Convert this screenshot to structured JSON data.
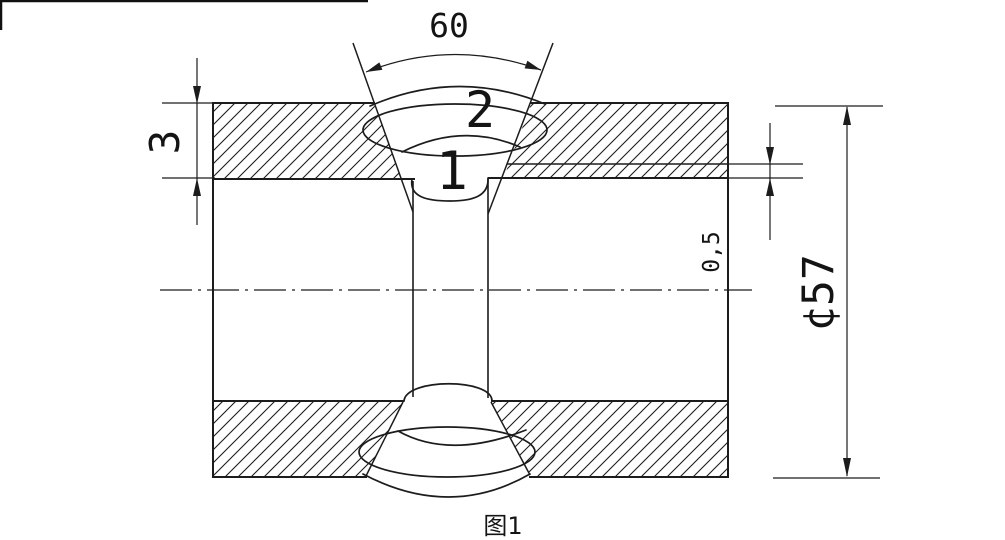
{
  "drawing": {
    "caption": "图1",
    "dimensions": {
      "groove_angle": "60",
      "wall_thickness": "3",
      "root_offset": "0,5",
      "outer_diameter": "¢57"
    },
    "weld_labels": {
      "root_pass": "1",
      "cap_pass": "2"
    }
  }
}
